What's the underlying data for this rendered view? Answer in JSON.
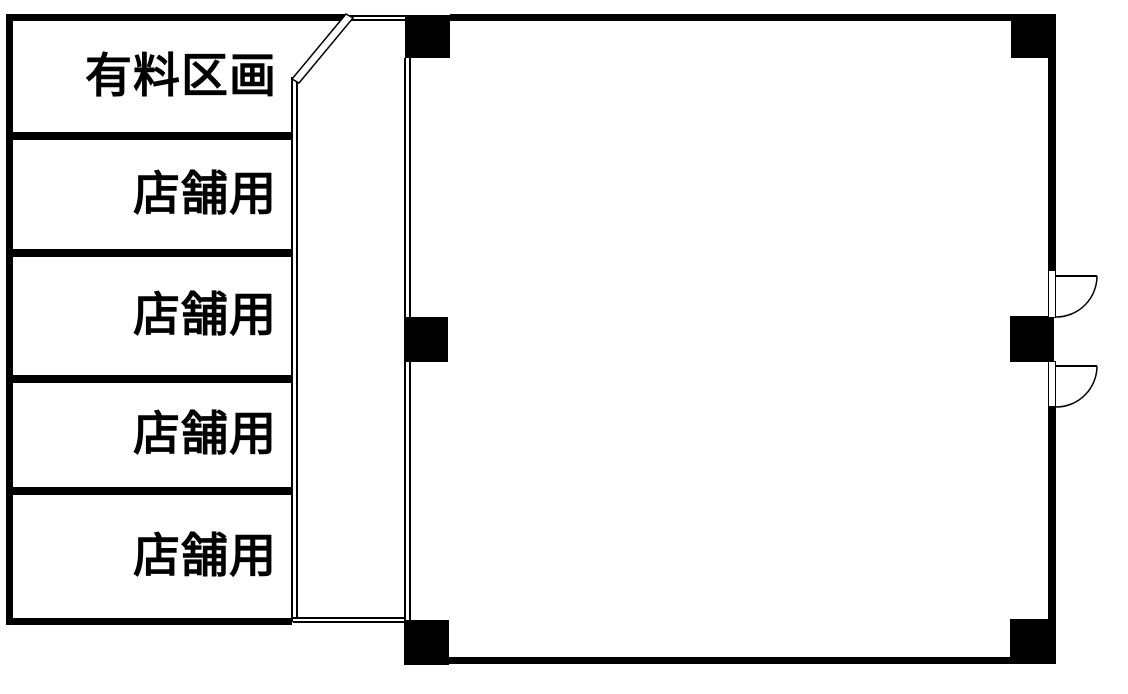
{
  "colors": {
    "wall": "#000000",
    "background": "#ffffff",
    "text": "#000000"
  },
  "left_block": {
    "rooms": [
      {
        "label": "有料区画"
      },
      {
        "label": "店舗用"
      },
      {
        "label": "店舗用"
      },
      {
        "label": "店舗用"
      },
      {
        "label": "店舗用"
      }
    ]
  },
  "main_room": {
    "label": "",
    "pillar_count": 6,
    "doors": [
      "right-wall-upper",
      "right-wall-lower"
    ]
  }
}
